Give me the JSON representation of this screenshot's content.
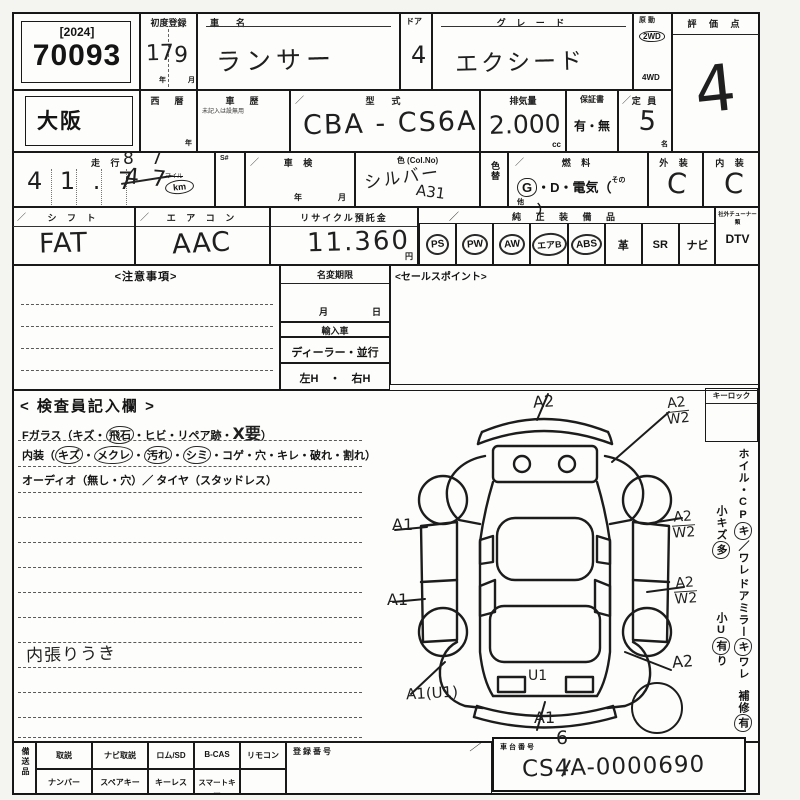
{
  "misc": {
    "check": "／",
    "dot": "・"
  },
  "header": {
    "year_tag": "[2024]",
    "lot_no": "70093",
    "first_reg_label": "初度登録",
    "first_reg_year": "17",
    "year_unit": "年",
    "first_reg_month": "9",
    "month_unit": "月",
    "car_name_label": "車　名",
    "car_name": "ランサー",
    "door_label": "ドア",
    "door": "4",
    "grade_label": "グ レ ー ド",
    "grade": "エクシード",
    "drive_label": "原動",
    "drive_2wd": "2WD",
    "drive_4wd": "4WD",
    "score_label": "評 価 点",
    "score": "4"
  },
  "row2": {
    "prefecture": "大阪",
    "seireki_label": "西　暦",
    "seireki_unit": "年",
    "shareki_label": "車　歴",
    "shareki_note": "未記入は設無用",
    "model_label": "型　式",
    "model": "CBA - CS6A",
    "disp_label": "排気量",
    "disp": "2.000",
    "disp_unit": "cc",
    "warranty_label": "保証書",
    "warranty": "有・無",
    "capacity_label": "定 員",
    "capacity": "5",
    "capacity_unit": "名"
  },
  "row3": {
    "mileage_label": "走 行",
    "mileage": "4 1 . 7",
    "mileage_crossed": "4 7",
    "mileage_fix": "8 7",
    "mile_unit": "マイル",
    "km_unit": "km",
    "sno_label": "S#",
    "shaken_label": "車 検",
    "shaken_year": "年",
    "shaken_month": "月",
    "color_label": "色 (Col.No)",
    "color": "シルバー",
    "color_code": "A31",
    "color_change": "色替",
    "fuel_label": "燃 料",
    "fuel_g": "G",
    "fuel_rest": "・D・電気（",
    "fuel_other": "その他",
    "fuel_close": "）",
    "ext_label": "外 装",
    "ext": "C",
    "int_label": "内 装",
    "int": "C"
  },
  "row4": {
    "shift_label": "シ フ ト",
    "shift": "FAT",
    "ac_label": "エ ア コ ン",
    "ac": "AAC",
    "recycle_label": "リサイクル預託金",
    "recycle": "11.360",
    "recycle_unit": "円",
    "equip_label": "純 正 装 備 品",
    "equip_items": [
      "PS",
      "PW",
      "AW",
      "エアB",
      "ABS",
      "革",
      "SR",
      "ナビ"
    ],
    "tuner_label": "社外チューナー類",
    "tuner": "DTV"
  },
  "mid": {
    "notes_label": "<注意事項>",
    "namechange_label": "名変期限",
    "month": "月",
    "day": "日",
    "import_label": "輸入車",
    "dealer": "ディーラー・並行",
    "handle": "左H　・　右H",
    "sales_label": "<セールスポイント>"
  },
  "inspector": {
    "title": "< 検査員記入欄 >",
    "l1_pre": "Fガラス（キズ・",
    "l1_circ": "飛石",
    "l1_mid": "・ヒビ・リペア跡・",
    "l1_hand": "X要",
    "l1_end": "）",
    "l2_pre": "内装（",
    "l2_c1": "キズ",
    "l2_c2": "メクレ",
    "l2_c3": "汚れ",
    "l2_c4": "シミ",
    "l2_rest": "・コゲ・穴・キレ・破れ・割れ）",
    "l3": "オーディオ（無し・穴）／ タイヤ（スタッドレス）",
    "note": "内張りうき"
  },
  "diagram": {
    "a_front": "A2",
    "a_fr_t": "A2",
    "a_fr_b": "W2",
    "a_left1": "A1",
    "a_left2": "A1",
    "a_r1_t": "A2",
    "a_r1_b": "W2",
    "a_r2_t": "A2",
    "a_r2_b": "W2",
    "a_r3": "A2",
    "a_trunk": "U1",
    "a_bl": "A1(U1)",
    "a_rear": "A1"
  },
  "right_margin": {
    "keylock": "キーロック",
    "v1_pre": "ホイル・CP",
    "v1_circ": "キ",
    "v1_post": "／ワレ",
    "v2_pre": "小キズ",
    "v2_circ": "多",
    "v3_pre": "ドアミラー",
    "v3_circ": "キ",
    "v3_post": "ワレ",
    "v4_pre": "小U",
    "v4_circ": "有",
    "v4_post": "り",
    "v5_pre": "補修",
    "v5_circ": "有"
  },
  "bottom": {
    "side_label": "備送品",
    "row1": [
      "取説",
      "ナビ取説",
      "ロム/SD",
      "B-CAS",
      "リモコン"
    ],
    "row2": [
      "ナンバー",
      "スペアキー",
      "キーレス",
      "スマートキー"
    ],
    "reg_label": "登録番号",
    "chassis_label": "車台番号",
    "chassis_pre": "CS",
    "chassis_crossed": "4",
    "chassis_fix": "6",
    "chassis_post": "A-0000690"
  }
}
